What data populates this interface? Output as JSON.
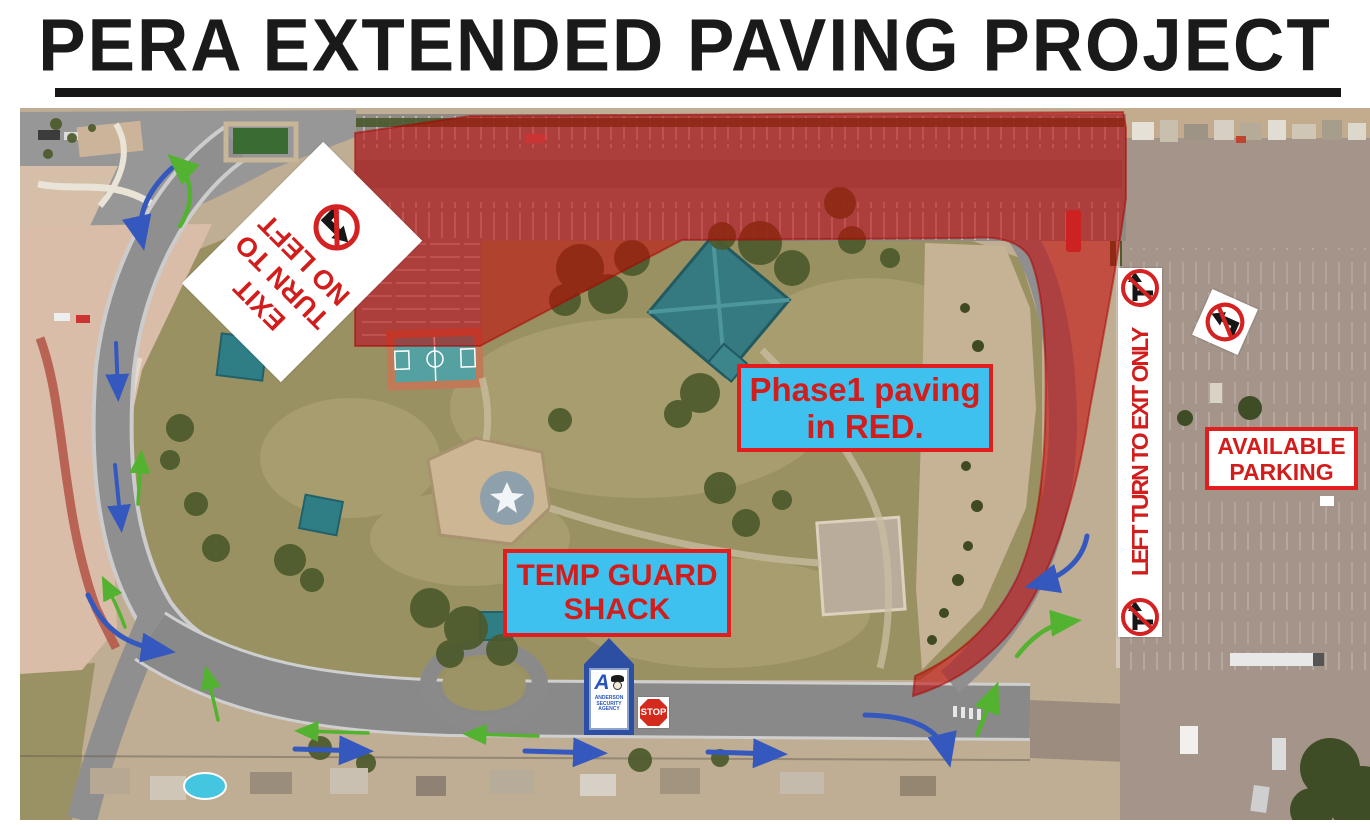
{
  "title": "PERA EXTENDED PAVING PROJECT",
  "colors": {
    "paving_overlay_red": "#c40404",
    "callout_cyan": "#3fc1f0",
    "callout_text_red": "#d21d1d",
    "arrow_blue": "#3558bf",
    "arrow_green": "#53b22f",
    "sign_red": "#d42222"
  },
  "callouts": {
    "phase1": {
      "line1": "Phase1 paving",
      "line2": "in RED."
    },
    "temp_guard_shack": {
      "line1": "TEMP GUARD",
      "line2": "SHACK"
    },
    "available_parking": {
      "line1": "AVAILABLE",
      "line2": "PARKING"
    }
  },
  "signs": {
    "no_left_turn_to_exit": {
      "line1": "NO LEFT",
      "line2": "TURN TO",
      "line3": "EXIT"
    },
    "left_turn_exit_only": {
      "text": "LEFT TURN TO EXIT ONLY"
    },
    "stop": {
      "text": "STOP"
    },
    "guard_shack": {
      "letter": "A",
      "company_line1": "ANDERSON",
      "company_line2": "SECURITY",
      "company_line3": "AGENCY"
    }
  }
}
